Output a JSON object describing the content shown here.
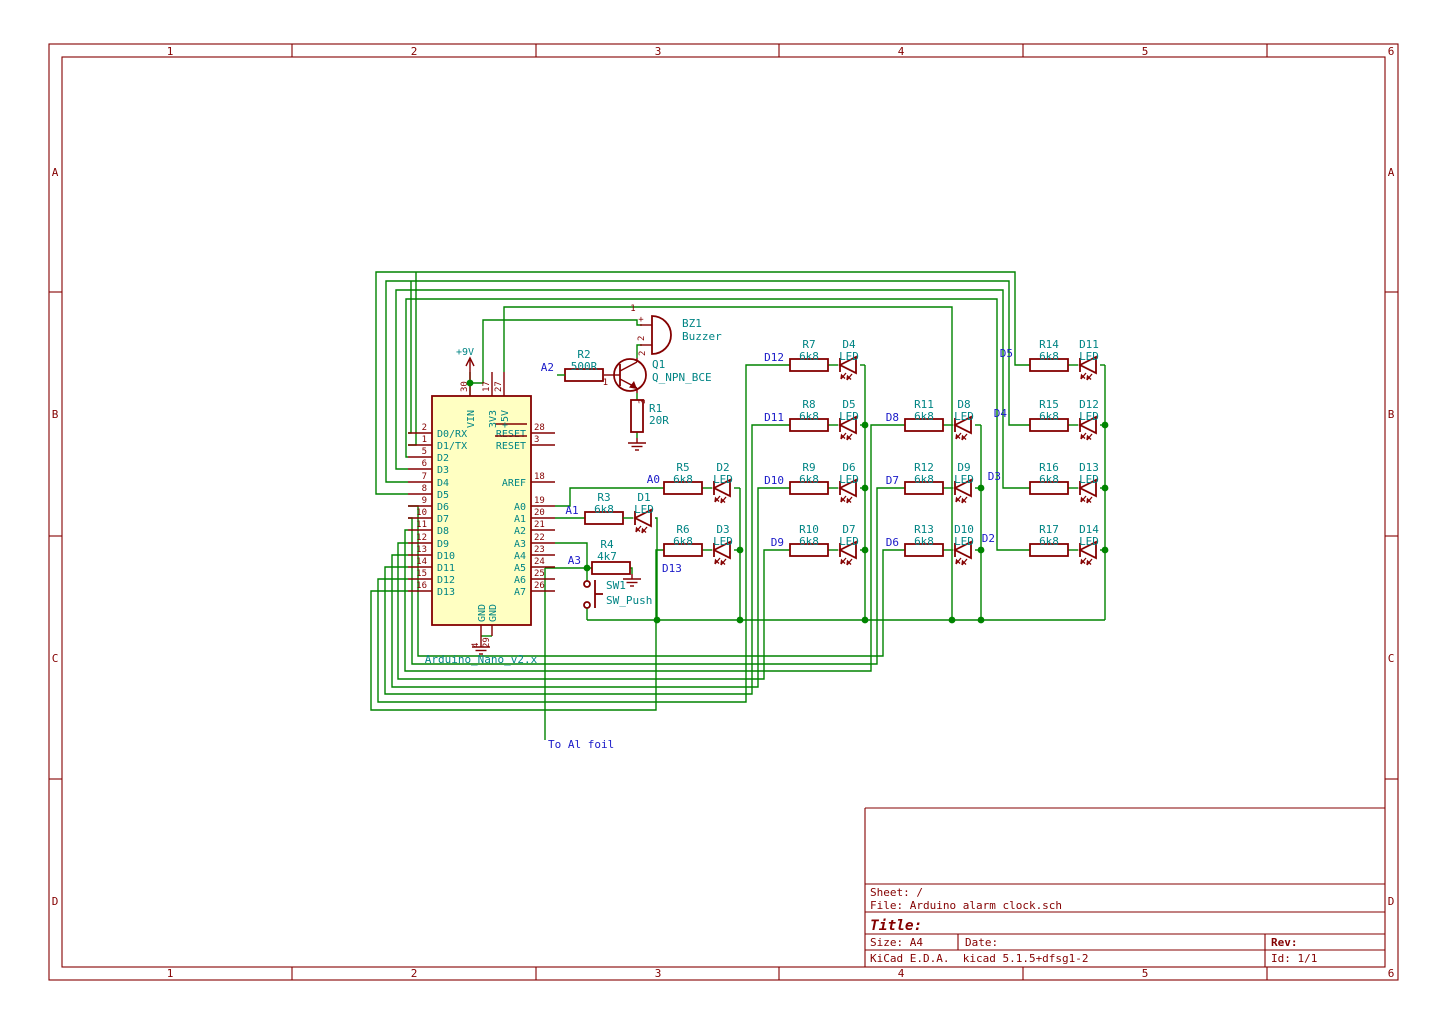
{
  "frame": {
    "columns": [
      "1",
      "2",
      "3",
      "4",
      "5",
      "6"
    ],
    "rows": [
      "A",
      "B",
      "C",
      "D"
    ]
  },
  "title_block": {
    "sheet": "Sheet: /",
    "file": "File: Arduino alarm clock.sch",
    "title": "Title:",
    "size": "Size: A4",
    "date": "Date:",
    "rev": "Rev:",
    "generator": "KiCad E.D.A.  kicad 5.1.5+dfsg1-2",
    "id": "Id: 1/1"
  },
  "power": {
    "v9": "+9V"
  },
  "misc": {
    "foil_label": "To Al foil"
  },
  "arduino": {
    "value": "Arduino_Nano_v2.x",
    "left_pins": [
      {
        "num": "2",
        "name": "D0/RX"
      },
      {
        "num": "1",
        "name": "D1/TX"
      },
      {
        "num": "5",
        "name": "D2"
      },
      {
        "num": "6",
        "name": "D3"
      },
      {
        "num": "7",
        "name": "D4"
      },
      {
        "num": "8",
        "name": "D5"
      },
      {
        "num": "9",
        "name": "D6"
      },
      {
        "num": "10",
        "name": "D7"
      },
      {
        "num": "11",
        "name": "D8"
      },
      {
        "num": "12",
        "name": "D9"
      },
      {
        "num": "13",
        "name": "D10"
      },
      {
        "num": "14",
        "name": "D11"
      },
      {
        "num": "15",
        "name": "D12"
      },
      {
        "num": "16",
        "name": "D13"
      }
    ],
    "right_pins": [
      {
        "num": "28",
        "name": "RESET"
      },
      {
        "num": "3",
        "name": "RESET"
      },
      {
        "num": "18",
        "name": "AREF"
      },
      {
        "num": "19",
        "name": "A0"
      },
      {
        "num": "20",
        "name": "A1"
      },
      {
        "num": "21",
        "name": "A2"
      },
      {
        "num": "22",
        "name": "A3"
      },
      {
        "num": "23",
        "name": "A4"
      },
      {
        "num": "24",
        "name": "A5"
      },
      {
        "num": "25",
        "name": "A6"
      },
      {
        "num": "26",
        "name": "A7"
      }
    ],
    "top_pins": [
      {
        "num": "30",
        "name": "VIN"
      },
      {
        "num": "17",
        "name": "3V3"
      },
      {
        "num": "27",
        "name": "+5V"
      }
    ],
    "bottom_pins": [
      {
        "num": "4",
        "name": "GND"
      },
      {
        "num": "29",
        "name": "GND"
      }
    ]
  },
  "components": {
    "bz1": {
      "ref": "BZ1",
      "value": "Buzzer",
      "pin1": "1",
      "plus": "+",
      "pin2": "2"
    },
    "q1": {
      "ref": "Q1",
      "value": "Q_NPN_BCE",
      "p1": "1",
      "p2": "2",
      "p3": "3"
    },
    "r1": {
      "ref": "R1",
      "value": "20R"
    },
    "r2": {
      "ref": "R2",
      "value": "500R",
      "net": "A2"
    },
    "r3": {
      "ref": "R3",
      "value": "6k8",
      "net": "A1",
      "led": "D1",
      "led_value": "LED"
    },
    "r4": {
      "ref": "R4",
      "value": "4k7",
      "net": "A3"
    },
    "sw1": {
      "ref": "SW1",
      "value": "SW_Push"
    }
  },
  "matrix": {
    "columns": [
      {
        "cells": [
          {
            "net": "A0",
            "res": "R5",
            "res_value": "6k8",
            "led": "D2",
            "led_value": "LED"
          },
          {
            "net": "D13",
            "res": "R6",
            "res_value": "6k8",
            "led": "D3",
            "led_value": "LED"
          }
        ]
      },
      {
        "cells": [
          {
            "net": "D12",
            "res": "R7",
            "res_value": "6k8",
            "led": "D4",
            "led_value": "LED"
          },
          {
            "net": "D11",
            "res": "R8",
            "res_value": "6k8",
            "led": "D5",
            "led_value": "LED"
          },
          {
            "net": "D10",
            "res": "R9",
            "res_value": "6k8",
            "led": "D6",
            "led_value": "LED"
          },
          {
            "net": "D9",
            "res": "R10",
            "res_value": "6k8",
            "led": "D7",
            "led_value": "LED"
          }
        ]
      },
      {
        "cells": [
          {
            "net": "D8",
            "res": "R11",
            "res_value": "6k8",
            "led": "D8",
            "led_value": "LED"
          },
          {
            "net": "D7",
            "res": "R12",
            "res_value": "6k8",
            "led": "D9",
            "led_value": "LED"
          },
          {
            "net": "D6",
            "res": "R13",
            "res_value": "6k8",
            "led": "D10",
            "led_value": "LED"
          }
        ]
      },
      {
        "cells": [
          {
            "net": "D5",
            "res": "R14",
            "res_value": "6k8",
            "led": "D11",
            "led_value": "LED"
          },
          {
            "net": "D4",
            "res": "R15",
            "res_value": "6k8",
            "led": "D12",
            "led_value": "LED"
          },
          {
            "net": "D3",
            "res": "R16",
            "res_value": "6k8",
            "led": "D13",
            "led_value": "LED"
          },
          {
            "net": "D2",
            "res": "R17",
            "res_value": "6k8",
            "led": "D14",
            "led_value": "LED"
          }
        ]
      }
    ]
  }
}
